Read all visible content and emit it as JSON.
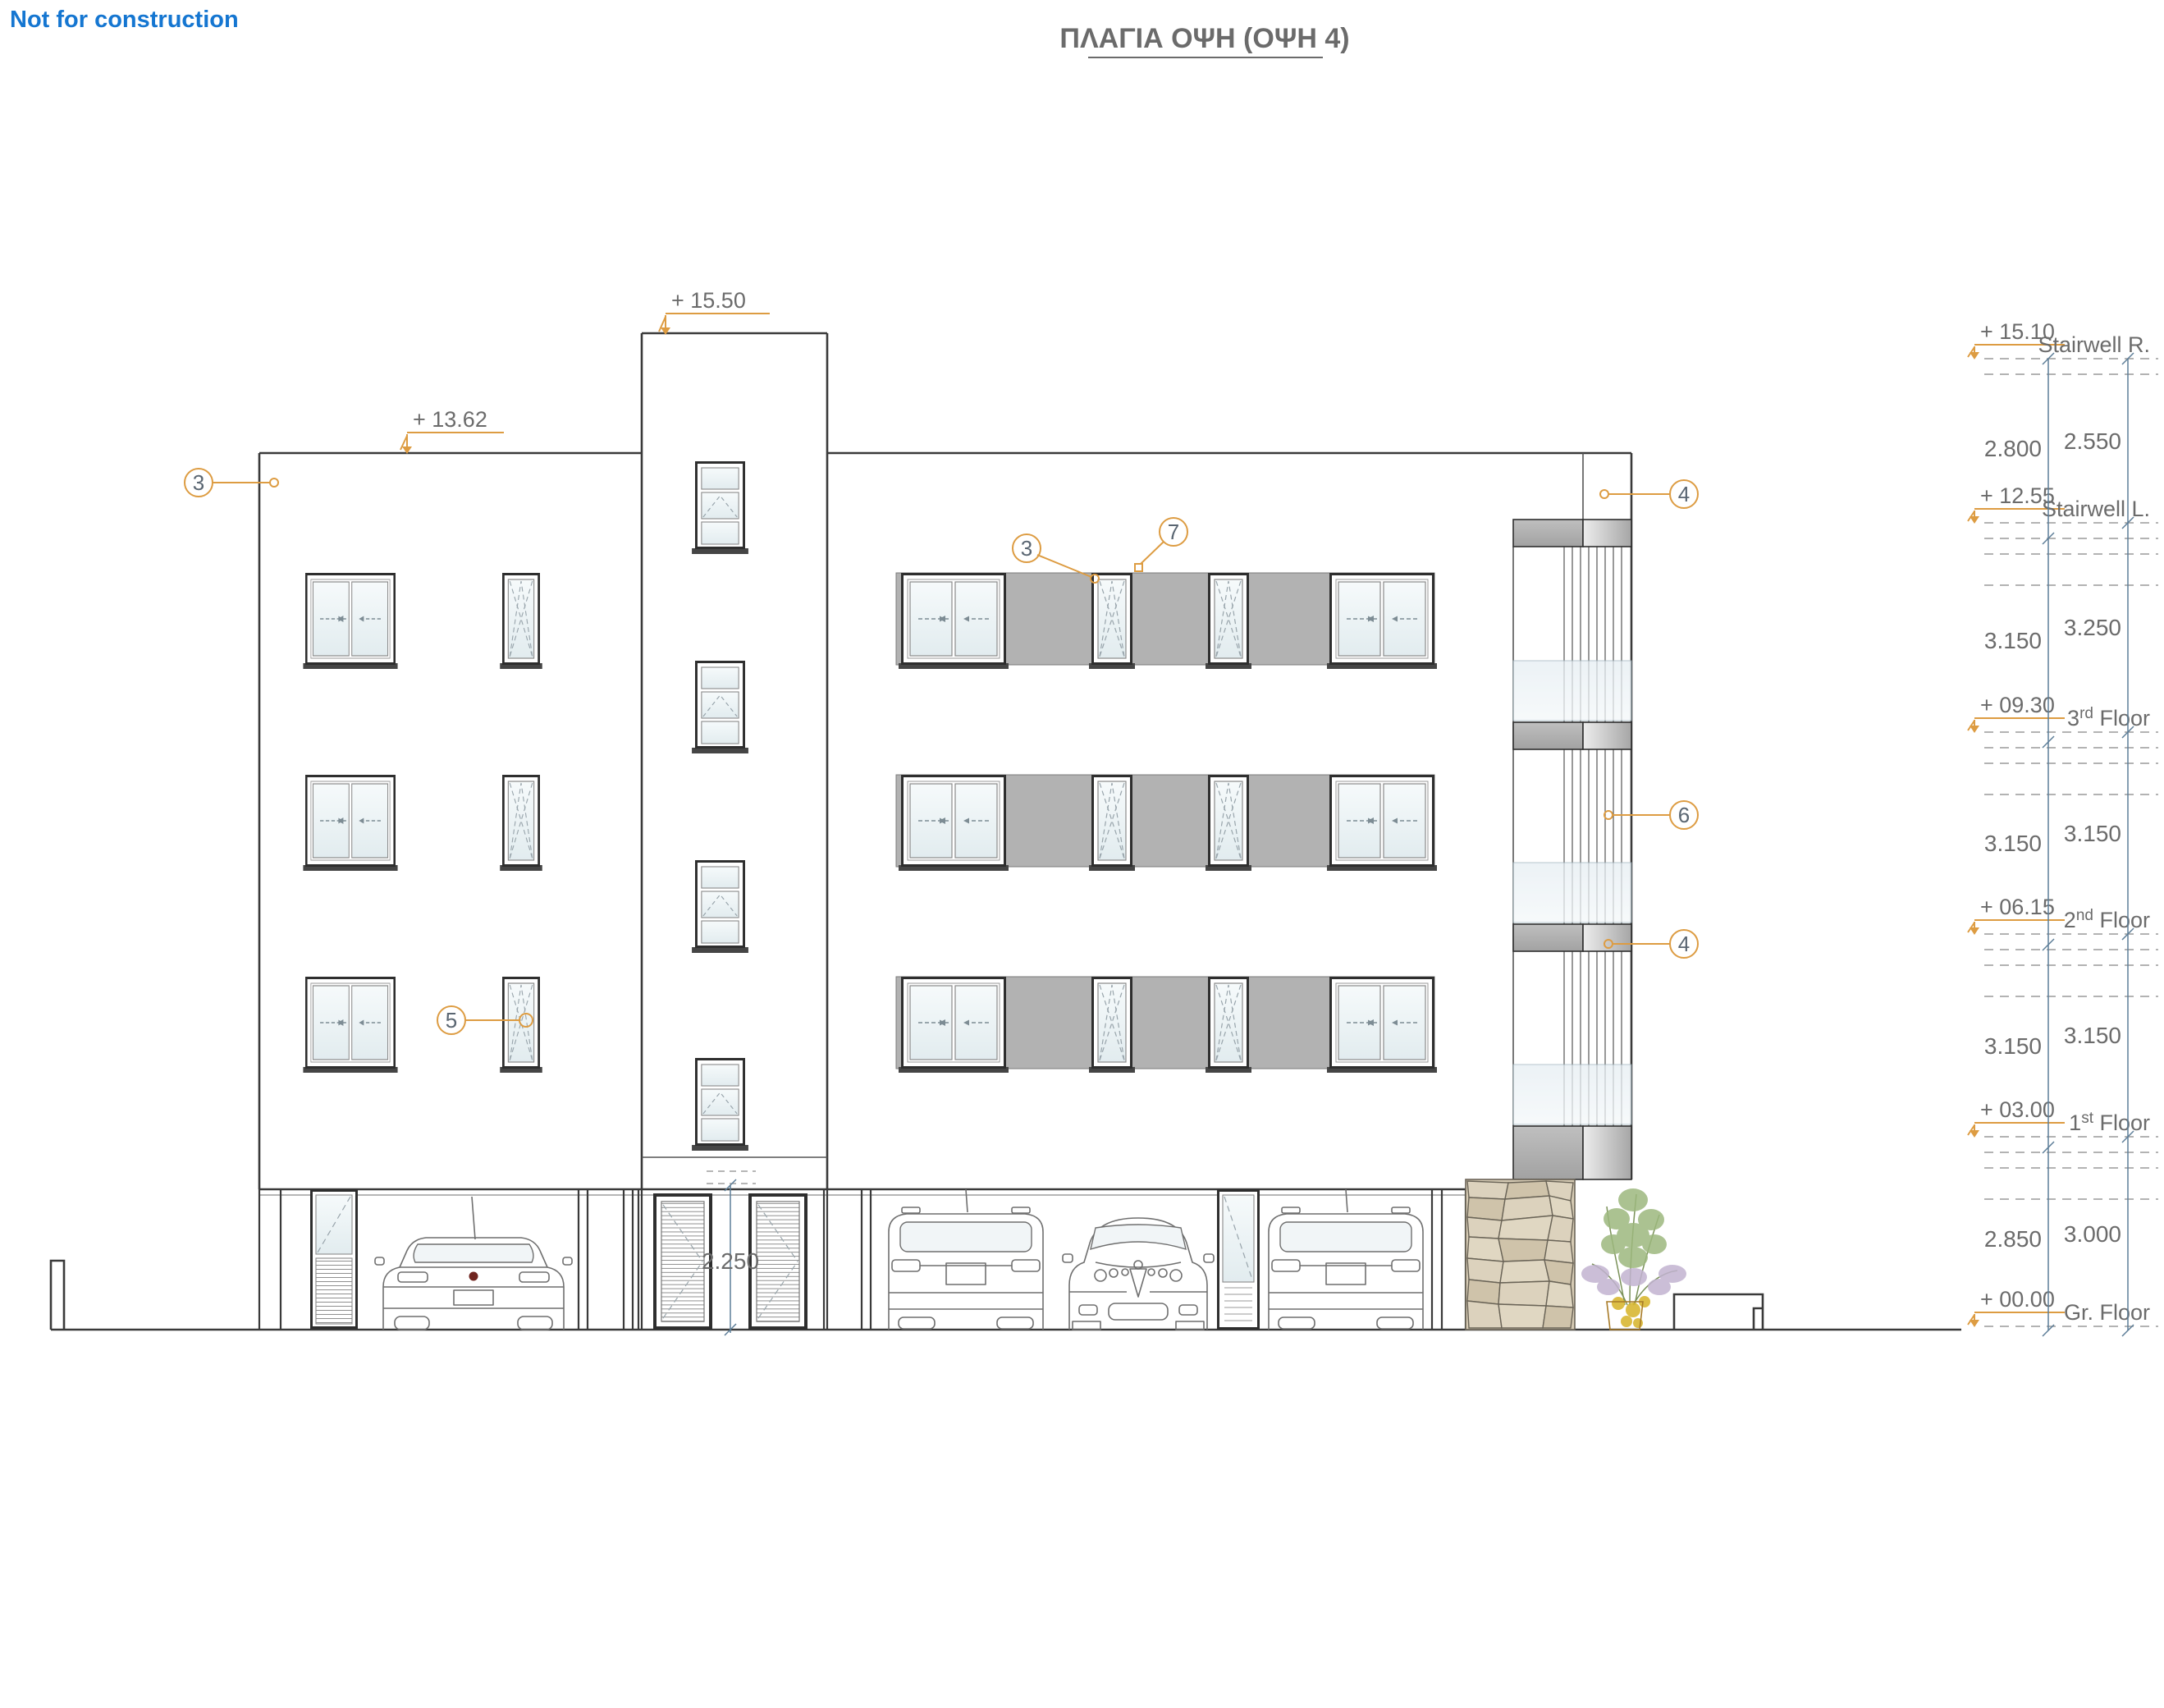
{
  "page": {
    "watermark": "Not for construction",
    "title": "ΠΛΑΓΙΑ ΟΨΗ  (ΟΨΗ 4)"
  },
  "colors": {
    "accent_orange": "#DD9C42",
    "dim_line_blue": "#5D7E98",
    "text_gray": "#6B6B6B",
    "callout_text": "#5A6672",
    "watermark_blue": "#1576D1",
    "line_dark": "#3A3A3A",
    "panel_gray": "#B2B2B2",
    "glass": "#EAF1F4",
    "stone": "#D6CBB4"
  },
  "building_markers": [
    {
      "name": "tower-roof",
      "elev": "+ 15.50"
    },
    {
      "name": "main-roof",
      "elev": "+ 13.62"
    }
  ],
  "entrance": {
    "height_dim": "2.250"
  },
  "callouts": [
    {
      "num": "3"
    },
    {
      "num": "5"
    },
    {
      "num": "3"
    },
    {
      "num": "7"
    },
    {
      "num": "4"
    },
    {
      "num": "6"
    },
    {
      "num": "4"
    }
  ],
  "scale": {
    "levels": [
      {
        "elev": "+ 15.10",
        "label_pre": "Stairwell R.",
        "label_sup": "",
        "label_post": ""
      },
      {
        "elev": "+ 12.55",
        "label_pre": "Stairwell L.",
        "label_sup": "",
        "label_post": ""
      },
      {
        "elev": "+ 09.30",
        "label_pre": "3",
        "label_sup": "rd",
        "label_post": " Floor"
      },
      {
        "elev": "+ 06.15",
        "label_pre": "2",
        "label_sup": "nd",
        "label_post": " Floor"
      },
      {
        "elev": "+ 03.00",
        "label_pre": "1",
        "label_sup": "st",
        "label_post": " Floor"
      },
      {
        "elev": "+ 00.00",
        "label_pre": "Gr. Floor",
        "label_sup": "",
        "label_post": ""
      }
    ],
    "dims_left": [
      "2.800",
      "3.150",
      "3.150",
      "3.150",
      "2.850"
    ],
    "dims_right": [
      "2.550",
      "3.250",
      "3.150",
      "3.150",
      "3.000"
    ]
  }
}
